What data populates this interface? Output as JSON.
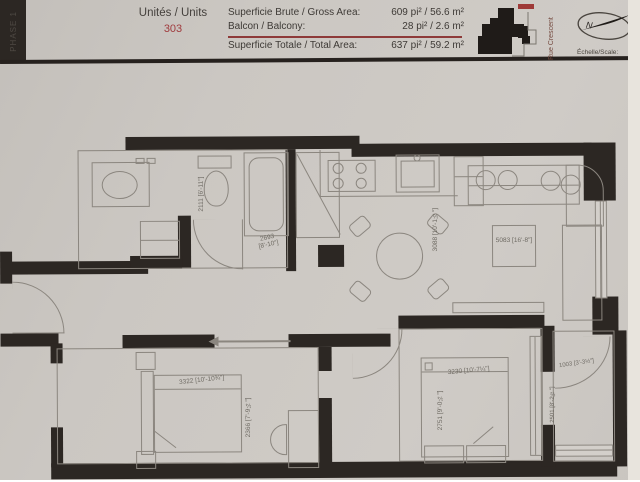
{
  "header": {
    "phase": "PHASE 1",
    "units_label": "Unités / Units",
    "unit_number": "303",
    "gross_label": "Superficie Brute / Gross Area:",
    "gross_value": "609 pi² / 56.6 m²",
    "balcony_label": "Balcon / Balcony:",
    "balcony_value": "28 pi² / 2.6 m²",
    "total_label": "Superficie Totale / Total Area:",
    "total_value": "637 pi² / 59.2 m²",
    "street": "Rue Crescent",
    "compass_n": "N",
    "scale_label": "Échelle/Scale:"
  },
  "colors": {
    "paper": "#cbc7c2",
    "wall": "#2c2723",
    "drawing_line": "#8b867f",
    "accent_red": "#a03b3e",
    "text": "#3e3a36"
  },
  "dims": {
    "bath_depth": "2111 [6'-11\"]",
    "bath_width": "2693 [8'-10\"]",
    "kitchen_depth": "3088 [10'-1½\"]",
    "living_width": "5083 [16'-8\"]",
    "bed1_width": "3322 [10'-10¾\"]",
    "bed1_depth": "2366 [7'-9¼\"]",
    "bed2_width": "3230 [10'-7¼\"]",
    "bed2_depth": "2751 [9'-0¼\"]",
    "balcony_width": "1003 [3'-3½\"]",
    "balcony_depth": "2501 [8'-2½\"]"
  }
}
